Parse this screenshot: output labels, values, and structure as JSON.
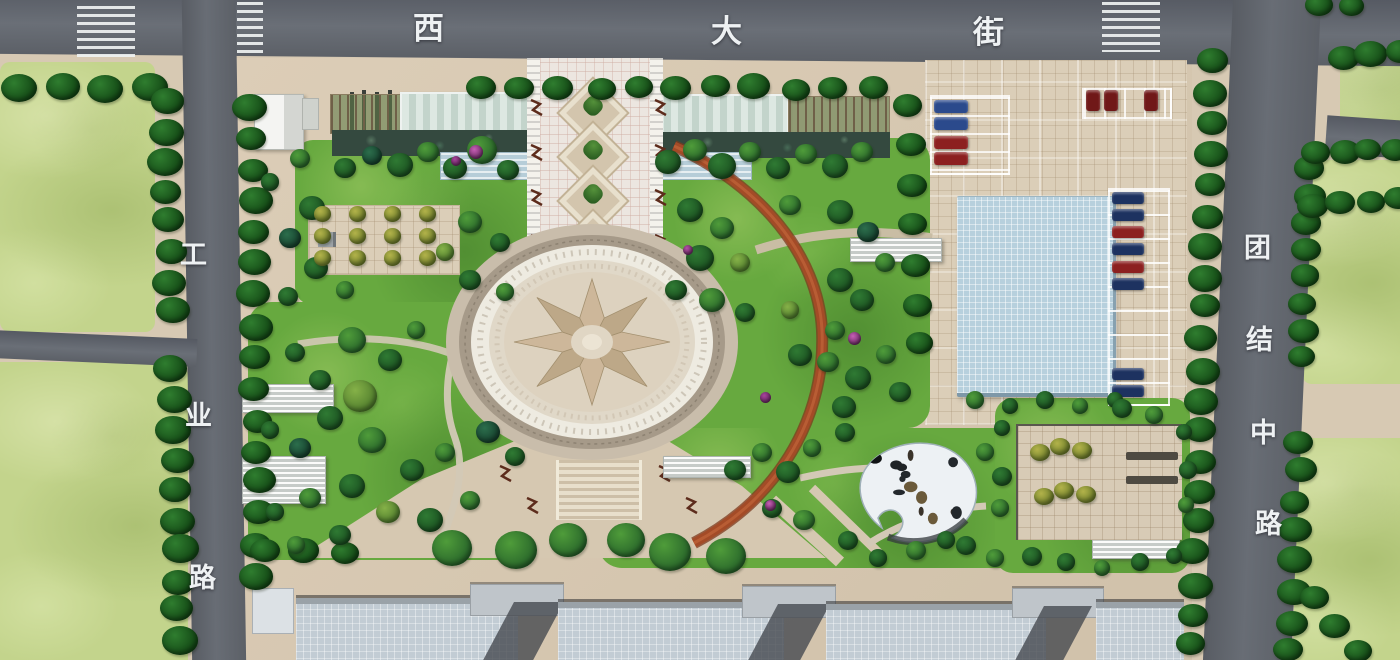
{
  "scene": {
    "type": "landscape master plan rendering",
    "streets": {
      "top": {
        "name": "西大街",
        "chars": [
          "西",
          "大",
          "街"
        ]
      },
      "left": {
        "name": "工业路",
        "chars": [
          "工",
          "业",
          "路"
        ]
      },
      "right": {
        "name": "团结中路",
        "chars": [
          "团",
          "结",
          "中",
          "路"
        ]
      }
    },
    "colors": {
      "road": "#63676e",
      "sidewalk": "#d7c9b3",
      "lawn": "#67a93f",
      "grass_field": "#c3d48c",
      "pool": "#b7d0dd",
      "red_path": "#a34b27",
      "street_tree": "#2f7d2f",
      "star_plaza_dark": "#bda888",
      "star_plaza_light": "#cdb79a",
      "car_blue": "#2b4a8c",
      "car_navy": "#1d3260",
      "car_red": "#8c2020"
    }
  }
}
